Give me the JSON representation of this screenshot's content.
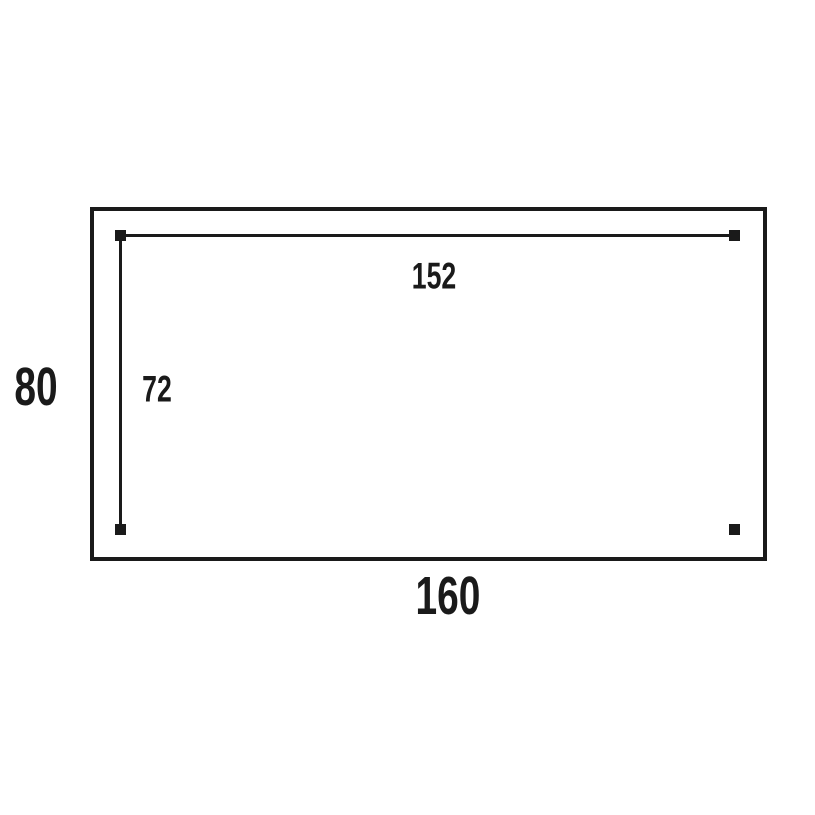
{
  "diagram": {
    "background_color": "#ffffff",
    "line_color": "#1a1a1a",
    "outer_rectangle": {
      "width_label": "160",
      "height_label": "80"
    },
    "inner_dimensions": {
      "width_label": "152",
      "height_label": "72"
    }
  }
}
